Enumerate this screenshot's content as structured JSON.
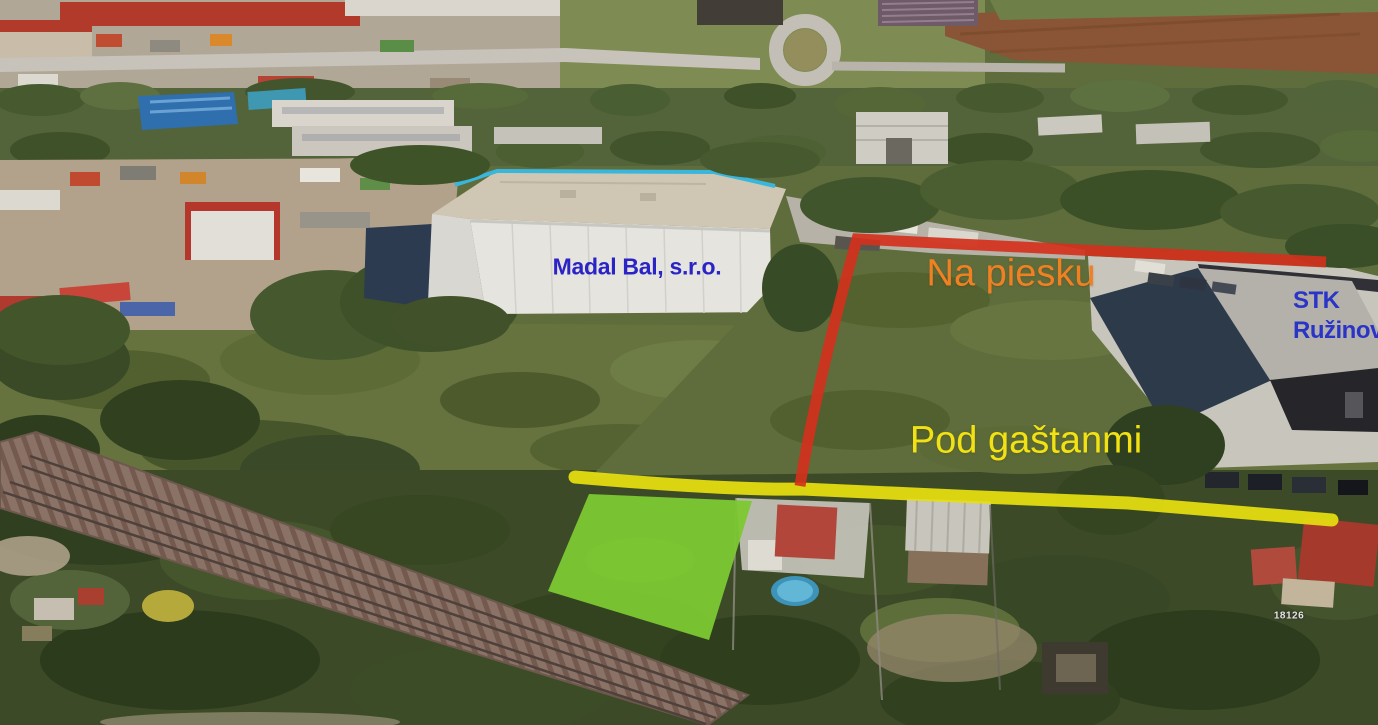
{
  "labels": {
    "madal_bal": "Madal Bal, s.r.o.",
    "na_piesku": "Na piesku",
    "stk_line1": "STK",
    "stk_line2": "Ružinov",
    "pod_gastanmi": "Pod gaštanmi",
    "parcel_number": "18126"
  },
  "annotations": {
    "na_piesku_line_color": "#d2311c",
    "pod_gastanmi_line_color": "#e6df10",
    "parcel_fill_color": "#7cc832",
    "madal_bal_text_color": "#2a24c6",
    "stk_text_color": "#2a35c8",
    "na_piesku_text_color": "#f08122",
    "pod_gastanmi_text_color": "#f2e213",
    "parcel_number_text_color": "#e4e4e0"
  }
}
